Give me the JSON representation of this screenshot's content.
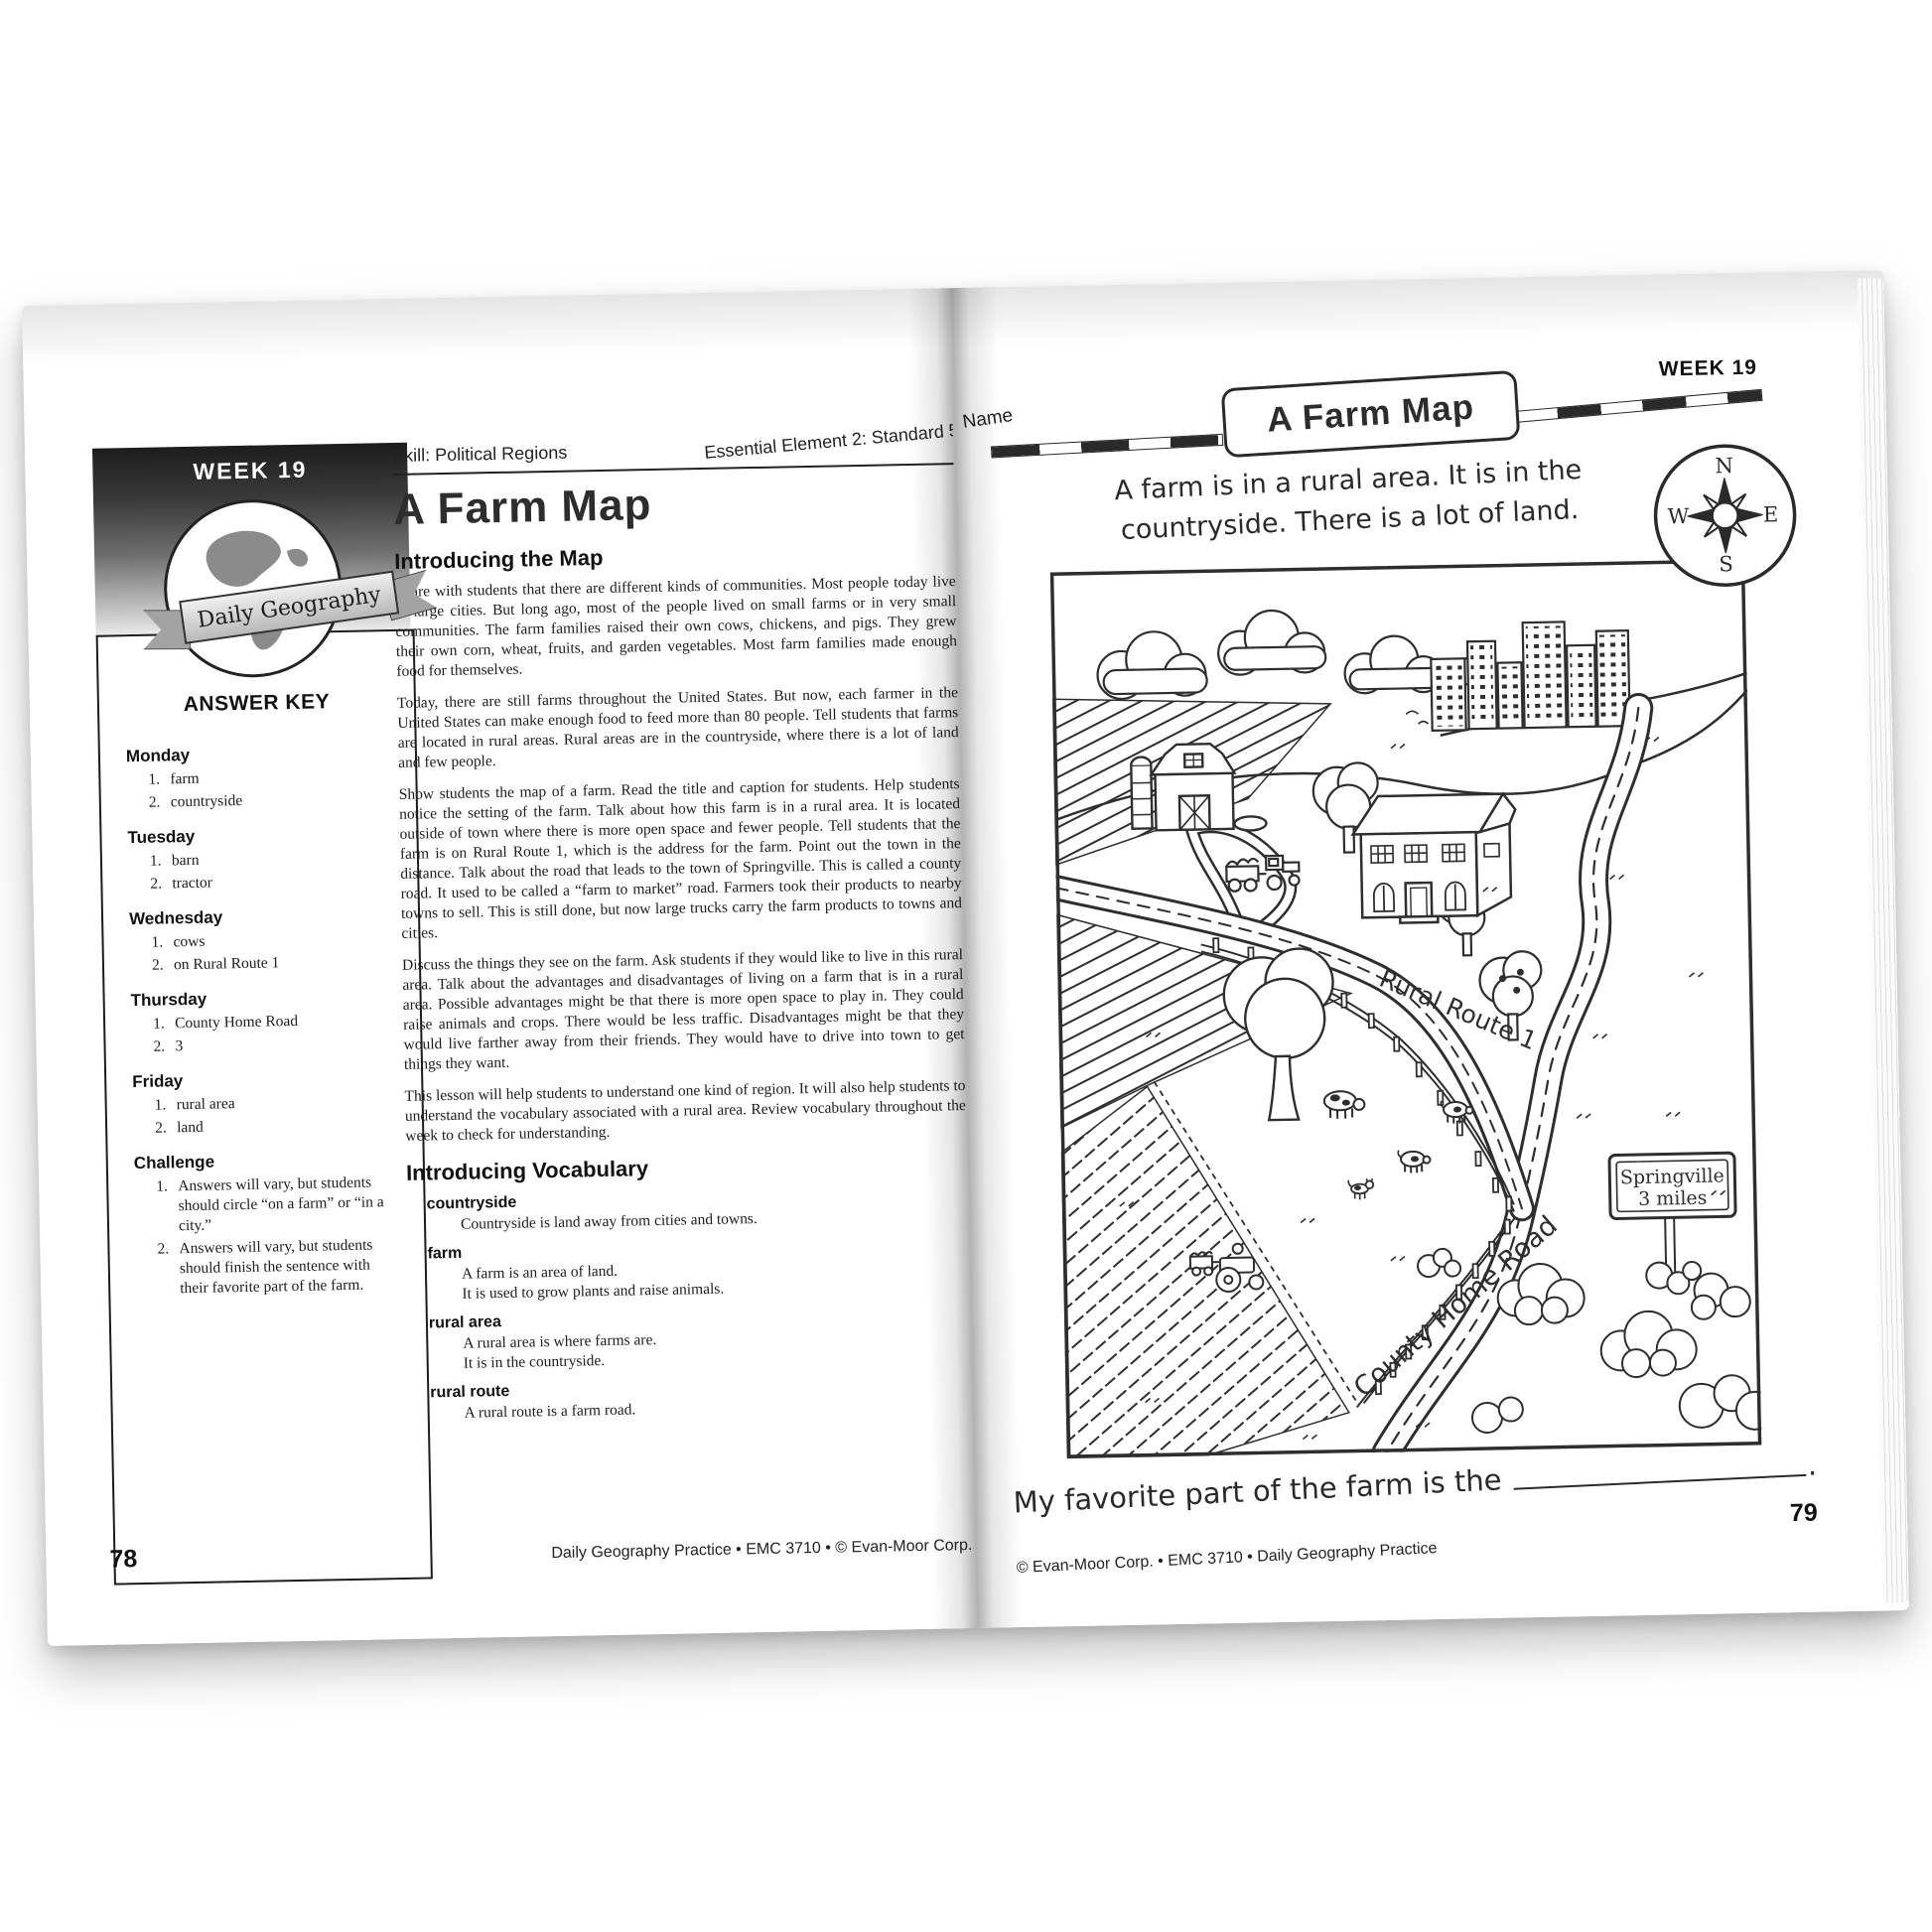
{
  "left_page": {
    "week_badge": "WEEK 19",
    "ribbon_text": "Daily Geography",
    "answer_key_title": "ANSWER KEY",
    "answer_key": [
      {
        "day": "Monday",
        "a1": "farm",
        "a2": "countryside"
      },
      {
        "day": "Tuesday",
        "a1": "barn",
        "a2": "tractor"
      },
      {
        "day": "Wednesday",
        "a1": "cows",
        "a2": "on Rural Route 1"
      },
      {
        "day": "Thursday",
        "a1": "County Home Road",
        "a2": "3"
      },
      {
        "day": "Friday",
        "a1": "rural area",
        "a2": "land"
      },
      {
        "day": "Challenge",
        "a1": "Answers will vary, but students should circle “on a farm” or “in a city.”",
        "a2": "Answers will vary, but students should finish the sentence with their favorite part of the farm."
      }
    ],
    "skill_label": "Skill: Political Regions",
    "standard_label": "Essential Element 2: Standard 5",
    "title": "A Farm Map",
    "intro_heading": "Introducing the Map",
    "paragraphs": [
      "Share with students that there are different kinds of communities. Most people today live in large cities. But long ago, most of the people lived on small farms or in very small communities. The farm families raised their own cows, chickens, and pigs. They grew their own corn, wheat, fruits, and garden vegetables. Most farm families made enough food for themselves.",
      "Today, there are still farms throughout the United States. But now, each farmer in the United States can make enough food to feed more than 80 people. Tell students that farms are located in rural areas. Rural areas are in the countryside, where there is a lot of land and few people.",
      "Show students the map of a farm. Read the title and caption for students. Help students notice the setting of the farm. Talk about how this farm is in a rural area. It is located outside of town where there is more open space and fewer people. Tell students that the farm is on Rural Route 1, which is the address for the farm. Point out the town in the distance. Talk about the road that leads to the town of Springville. This is called a county road. It used to be called a “farm to market” road. Farmers took their products to nearby towns to sell. This is still done, but now large trucks carry the farm products to towns and cities.",
      "Discuss the things they see on the farm. Ask students if they would like to live in this rural area. Talk about the advantages and disadvantages of living on a farm that is in a rural area. Possible advantages might be that there is more open space to play in. They could raise animals and crops. There would be less traffic. Disadvantages might be that they would live farther away from their friends. They would have to drive into town to get things they want.",
      "This lesson will help students to understand one kind of region. It will also help students to understand the vocabulary associated with a rural area. Review vocabulary throughout the week to check for understanding."
    ],
    "vocab_heading": "Introducing Vocabulary",
    "vocab": [
      {
        "term": "countryside",
        "def1": "Countryside is land away from cities and towns."
      },
      {
        "term": "farm",
        "def1": "A farm is an area of land.",
        "def2": "It is used to grow plants and raise animals."
      },
      {
        "term": "rural area",
        "def1": "A rural area is where farms are.",
        "def2": "It is in the countryside."
      },
      {
        "term": "rural route",
        "def1": "A rural route is a farm road."
      }
    ],
    "page_number": "78",
    "footer": "Daily Geography Practice • EMC 3710 • © Evan-Moor Corp."
  },
  "right_page": {
    "week_label": "WEEK 19",
    "name_label": "Name",
    "banner_title": "A Farm Map",
    "caption_line1": "A farm is in a rural area. It is in the",
    "caption_line2": "countryside. There is a lot of land.",
    "compass": {
      "north": "N",
      "east": "E",
      "south": "S",
      "west": "W"
    },
    "map_labels": {
      "rural_route": "Rural Route 1",
      "county_road": "County Home Road",
      "sign_line1": "Springville",
      "sign_line2": "3 miles"
    },
    "prompt": "My favorite part of the farm is the",
    "prompt_period": ".",
    "page_number": "79",
    "footer": "© Evan-Moor Corp. • EMC 3710 • Daily Geography Practice"
  }
}
